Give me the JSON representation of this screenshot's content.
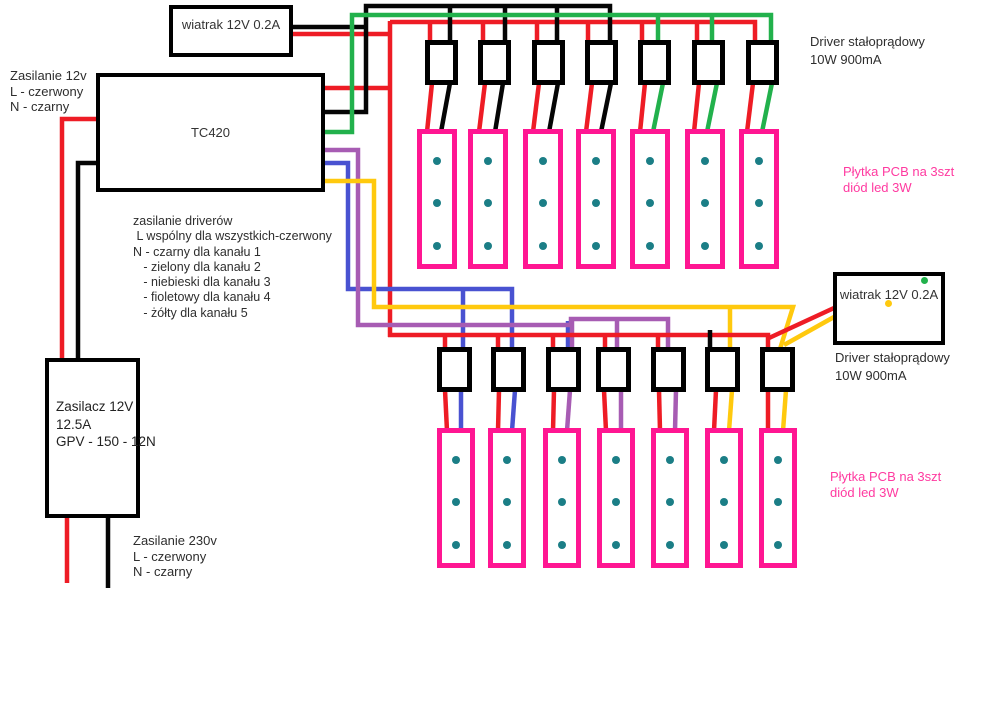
{
  "canvas": {
    "width": 1000,
    "height": 708,
    "background": "#ffffff"
  },
  "colors": {
    "red": "#ee1c25",
    "black": "#050505",
    "green": "#22b14c",
    "blue": "#4952d1",
    "purple": "#a75cb3",
    "yellow": "#ffc90e",
    "pink": "#ff1692",
    "pink_text": "#ff3aa0",
    "teal": "#1b7e86",
    "label_text": "#2e2e2e"
  },
  "labels": {
    "fan_top": "wiatrak 12V 0.2A",
    "fan_right": "wiatrak 12V 0.2A",
    "controller": "TC420",
    "psu": "Zasilacz 12V\n12.5A\nGPV - 150 - 12N",
    "supply_12v_note": "Zasilanie 12v\nL - czerwony\nN - czarny",
    "driver_supply_note": "zasilanie driverów\n L wspólny dla wszystkich-czerwony\nN - czarny dla kanału 1\n   - zielony dla kanału 2\n   - niebieski dla kanału 3\n   - fioletowy dla kanału 4\n   - żółty dla kanału 5",
    "mains_note": "Zasilanie 230v\nL - czerwony\nN - czarny",
    "driver_label_top": "Driver stałoprądowy\n10W 900mA",
    "driver_label_bottom": "Driver stałoprądowy\n10W 900mA",
    "pcb_label_top": "Płytka PCB na 3szt\ndiód led 3W",
    "pcb_label_bottom": "Płytka PCB na 3szt\ndiód led 3W"
  },
  "boards": {
    "top_drivers": {
      "y": 40,
      "w": 33,
      "h": 45,
      "xs": [
        425,
        478,
        532,
        585,
        638,
        692,
        746
      ]
    },
    "top_pcbs": {
      "y": 129,
      "w": 40,
      "h": 140,
      "xs": [
        417,
        468,
        523,
        576,
        630,
        685,
        739
      ],
      "led_offsets": [
        28,
        70,
        113
      ]
    },
    "bottom_drivers": {
      "y": 347,
      "w": 35,
      "h": 45,
      "xs": [
        437,
        491,
        546,
        596,
        651,
        705,
        760
      ]
    },
    "bottom_pcbs": {
      "y": 428,
      "w": 38,
      "h": 140,
      "xs": [
        437,
        488,
        543,
        597,
        651,
        705,
        759
      ],
      "led_offsets": [
        28,
        70,
        113
      ]
    }
  },
  "fan_right_dots": [
    {
      "name": "fan2-green-dot",
      "color": "green",
      "x": 921,
      "y": 277
    },
    {
      "name": "fan2-yellow-dot",
      "color": "yellow",
      "x": 885,
      "y": 300
    }
  ],
  "wires": [
    {
      "name": "psu-red-wire",
      "color": "red",
      "pts": [
        [
          98,
          119
        ],
        [
          62,
          119
        ],
        [
          62,
          360
        ]
      ]
    },
    {
      "name": "psu-black-wire",
      "color": "black",
      "pts": [
        [
          98,
          163
        ],
        [
          78,
          163
        ],
        [
          78,
          360
        ]
      ]
    },
    {
      "name": "mains-red-wire",
      "color": "red",
      "pts": [
        [
          67,
          516
        ],
        [
          67,
          583
        ]
      ]
    },
    {
      "name": "mains-black-wire",
      "color": "black",
      "pts": [
        [
          108,
          516
        ],
        [
          108,
          588
        ]
      ]
    },
    {
      "name": "fan1-black-wire",
      "color": "black",
      "pts": [
        [
          291,
          27
        ],
        [
          368,
          27
        ]
      ]
    },
    {
      "name": "fan1-red-wire",
      "color": "red",
      "pts": [
        [
          291,
          34
        ],
        [
          391,
          34
        ]
      ]
    },
    {
      "name": "red-common-vertical",
      "color": "red",
      "pts": [
        [
          390,
          21
        ],
        [
          390,
          337
        ]
      ]
    },
    {
      "name": "red-tc420-out",
      "color": "red",
      "pts": [
        [
          322,
          88
        ],
        [
          390,
          88
        ]
      ]
    },
    {
      "name": "red-top-bus",
      "color": "red",
      "pts": [
        [
          390,
          22
        ],
        [
          755,
          22
        ],
        [
          755,
          42
        ]
      ]
    },
    {
      "name": "red-top-drop-driver1",
      "color": "red",
      "pts": [
        [
          430,
          22
        ],
        [
          430,
          42
        ]
      ]
    },
    {
      "name": "red-top-drop-driver2",
      "color": "red",
      "pts": [
        [
          483,
          22
        ],
        [
          483,
          42
        ]
      ]
    },
    {
      "name": "red-top-drop-driver3",
      "color": "red",
      "pts": [
        [
          537,
          22
        ],
        [
          537,
          42
        ]
      ]
    },
    {
      "name": "red-top-drop-driver4",
      "color": "red",
      "pts": [
        [
          588,
          22
        ],
        [
          588,
          42
        ]
      ]
    },
    {
      "name": "red-top-drop-driver5",
      "color": "red",
      "pts": [
        [
          642,
          22
        ],
        [
          642,
          42
        ]
      ]
    },
    {
      "name": "red-top-drop-driver6",
      "color": "red",
      "pts": [
        [
          697,
          22
        ],
        [
          697,
          42
        ]
      ]
    },
    {
      "name": "ch1-black-wire",
      "color": "black",
      "pts": [
        [
          322,
          112
        ],
        [
          366,
          112
        ],
        [
          366,
          6
        ],
        [
          610,
          6
        ],
        [
          610,
          42
        ]
      ]
    },
    {
      "name": "ch1-drop-driver1",
      "color": "black",
      "pts": [
        [
          450,
          6
        ],
        [
          450,
          42
        ]
      ]
    },
    {
      "name": "ch1-drop-driver2",
      "color": "black",
      "pts": [
        [
          505,
          6
        ],
        [
          505,
          42
        ]
      ]
    },
    {
      "name": "ch1-drop-driver3",
      "color": "black",
      "pts": [
        [
          557,
          6
        ],
        [
          557,
          42
        ]
      ]
    },
    {
      "name": "ch2-green-wire",
      "color": "green",
      "pts": [
        [
          322,
          132
        ],
        [
          352,
          132
        ],
        [
          352,
          15
        ],
        [
          771,
          15
        ],
        [
          771,
          42
        ]
      ]
    },
    {
      "name": "ch2-drop-driver5",
      "color": "green",
      "pts": [
        [
          658,
          15
        ],
        [
          658,
          42
        ]
      ]
    },
    {
      "name": "ch2-drop-driver6",
      "color": "green",
      "pts": [
        [
          712,
          15
        ],
        [
          712,
          42
        ]
      ]
    },
    {
      "name": "top-driver1-out-red",
      "color": "red",
      "pts": [
        [
          432,
          83
        ],
        [
          427,
          132
        ]
      ]
    },
    {
      "name": "top-driver1-out-black",
      "color": "black",
      "pts": [
        [
          450,
          83
        ],
        [
          441,
          132
        ]
      ]
    },
    {
      "name": "top-driver2-out-red",
      "color": "red",
      "pts": [
        [
          485,
          83
        ],
        [
          479,
          132
        ]
      ]
    },
    {
      "name": "top-driver2-out-black",
      "color": "black",
      "pts": [
        [
          503,
          83
        ],
        [
          495,
          132
        ]
      ]
    },
    {
      "name": "top-driver3-out-red",
      "color": "red",
      "pts": [
        [
          539,
          83
        ],
        [
          533,
          132
        ]
      ]
    },
    {
      "name": "top-driver3-out-black",
      "color": "black",
      "pts": [
        [
          558,
          83
        ],
        [
          549,
          132
        ]
      ]
    },
    {
      "name": "top-driver4-out-red",
      "color": "red",
      "pts": [
        [
          592,
          83
        ],
        [
          586,
          132
        ]
      ]
    },
    {
      "name": "top-driver4-out-black",
      "color": "black",
      "pts": [
        [
          611,
          83
        ],
        [
          601,
          132
        ]
      ]
    },
    {
      "name": "top-driver5-out-red",
      "color": "red",
      "pts": [
        [
          645,
          83
        ],
        [
          640,
          132
        ]
      ]
    },
    {
      "name": "top-driver5-out-green",
      "color": "green",
      "pts": [
        [
          663,
          83
        ],
        [
          653,
          132
        ]
      ]
    },
    {
      "name": "top-driver6-out-red",
      "color": "red",
      "pts": [
        [
          699,
          83
        ],
        [
          694,
          132
        ]
      ]
    },
    {
      "name": "top-driver6-out-green",
      "color": "green",
      "pts": [
        [
          717,
          83
        ],
        [
          707,
          132
        ]
      ]
    },
    {
      "name": "top-driver7-out-red",
      "color": "red",
      "pts": [
        [
          753,
          83
        ],
        [
          747,
          132
        ]
      ]
    },
    {
      "name": "top-driver7-out-green",
      "color": "green",
      "pts": [
        [
          772,
          83
        ],
        [
          762,
          132
        ]
      ]
    },
    {
      "name": "ch3-blue-wire",
      "color": "blue",
      "pts": [
        [
          322,
          163
        ],
        [
          348,
          163
        ],
        [
          348,
          289
        ],
        [
          512,
          289
        ],
        [
          512,
          349
        ]
      ]
    },
    {
      "name": "ch3-drop-driver1",
      "color": "blue",
      "pts": [
        [
          463,
          289
        ],
        [
          463,
          349
        ]
      ]
    },
    {
      "name": "stray-blue-driver3",
      "color": "blue",
      "pts": [
        [
          568,
          321
        ],
        [
          568,
          350
        ]
      ]
    },
    {
      "name": "ch4-purple-wire",
      "color": "purple",
      "pts": [
        [
          322,
          150
        ],
        [
          358,
          150
        ],
        [
          358,
          325
        ],
        [
          571,
          325
        ],
        [
          571,
          319
        ],
        [
          668,
          319
        ],
        [
          668,
          349
        ]
      ]
    },
    {
      "name": "ch4-drop-driver3",
      "color": "purple",
      "pts": [
        [
          572,
          321
        ],
        [
          572,
          349
        ]
      ]
    },
    {
      "name": "ch4-drop-driver4",
      "color": "purple",
      "pts": [
        [
          617,
          319
        ],
        [
          617,
          349
        ]
      ]
    },
    {
      "name": "ch5-yellow-wire",
      "color": "yellow",
      "pts": [
        [
          322,
          181
        ],
        [
          374,
          181
        ],
        [
          374,
          307
        ],
        [
          793,
          307
        ],
        [
          780,
          349
        ]
      ]
    },
    {
      "name": "ch5-drop-driver6",
      "color": "yellow",
      "pts": [
        [
          730,
          307
        ],
        [
          730,
          349
        ]
      ]
    },
    {
      "name": "red-bottom-bus",
      "color": "red",
      "pts": [
        [
          388,
          335
        ],
        [
          768,
          335
        ],
        [
          768,
          349
        ]
      ]
    },
    {
      "name": "red-bot-drop-driver1",
      "color": "red",
      "pts": [
        [
          445,
          335
        ],
        [
          445,
          349
        ]
      ]
    },
    {
      "name": "red-bot-drop-driver2",
      "color": "red",
      "pts": [
        [
          498,
          335
        ],
        [
          498,
          349
        ]
      ]
    },
    {
      "name": "red-bot-drop-driver3",
      "color": "red",
      "pts": [
        [
          553,
          335
        ],
        [
          553,
          349
        ]
      ]
    },
    {
      "name": "red-bot-drop-driver4",
      "color": "red",
      "pts": [
        [
          605,
          335
        ],
        [
          605,
          349
        ]
      ]
    },
    {
      "name": "red-bot-drop-driver5",
      "color": "red",
      "pts": [
        [
          658,
          335
        ],
        [
          658,
          349
        ]
      ]
    },
    {
      "name": "driver6-black-drop",
      "color": "black",
      "pts": [
        [
          710,
          330
        ],
        [
          710,
          349
        ]
      ]
    },
    {
      "name": "fan2-red-wire",
      "color": "red",
      "pts": [
        [
          834,
          308
        ],
        [
          769,
          338
        ]
      ]
    },
    {
      "name": "fan2-yellow-wire",
      "color": "yellow",
      "pts": [
        [
          834,
          317
        ],
        [
          784,
          345
        ]
      ]
    },
    {
      "name": "bot-driver1-out-red",
      "color": "red",
      "pts": [
        [
          445,
          390
        ],
        [
          447,
          431
        ]
      ]
    },
    {
      "name": "bot-driver1-out-blue",
      "color": "blue",
      "pts": [
        [
          461,
          390
        ],
        [
          461,
          431
        ]
      ]
    },
    {
      "name": "bot-driver2-out-red",
      "color": "red",
      "pts": [
        [
          499,
          390
        ],
        [
          498,
          431
        ]
      ]
    },
    {
      "name": "bot-driver2-out-blue",
      "color": "blue",
      "pts": [
        [
          515,
          390
        ],
        [
          512,
          431
        ]
      ]
    },
    {
      "name": "bot-driver3-out-red",
      "color": "red",
      "pts": [
        [
          554,
          390
        ],
        [
          553,
          431
        ]
      ]
    },
    {
      "name": "bot-driver3-out-purple",
      "color": "purple",
      "pts": [
        [
          570,
          390
        ],
        [
          567,
          431
        ]
      ]
    },
    {
      "name": "bot-driver4-out-red",
      "color": "red",
      "pts": [
        [
          604,
          390
        ],
        [
          606,
          431
        ]
      ]
    },
    {
      "name": "bot-driver4-out-purple",
      "color": "purple",
      "pts": [
        [
          621,
          390
        ],
        [
          621,
          431
        ]
      ]
    },
    {
      "name": "bot-driver5-out-red",
      "color": "red",
      "pts": [
        [
          659,
          390
        ],
        [
          660,
          431
        ]
      ]
    },
    {
      "name": "bot-driver5-out-purple",
      "color": "purple",
      "pts": [
        [
          676,
          390
        ],
        [
          675,
          431
        ]
      ]
    },
    {
      "name": "bot-driver6-out-red",
      "color": "red",
      "pts": [
        [
          716,
          390
        ],
        [
          714,
          431
        ]
      ]
    },
    {
      "name": "bot-driver6-out-yellow",
      "color": "yellow",
      "pts": [
        [
          732,
          390
        ],
        [
          729,
          431
        ]
      ]
    },
    {
      "name": "bot-driver7-out-red",
      "color": "red",
      "pts": [
        [
          768,
          390
        ],
        [
          768,
          431
        ]
      ]
    },
    {
      "name": "bot-driver7-out-yellow",
      "color": "yellow",
      "pts": [
        [
          786,
          390
        ],
        [
          783,
          431
        ]
      ]
    }
  ]
}
